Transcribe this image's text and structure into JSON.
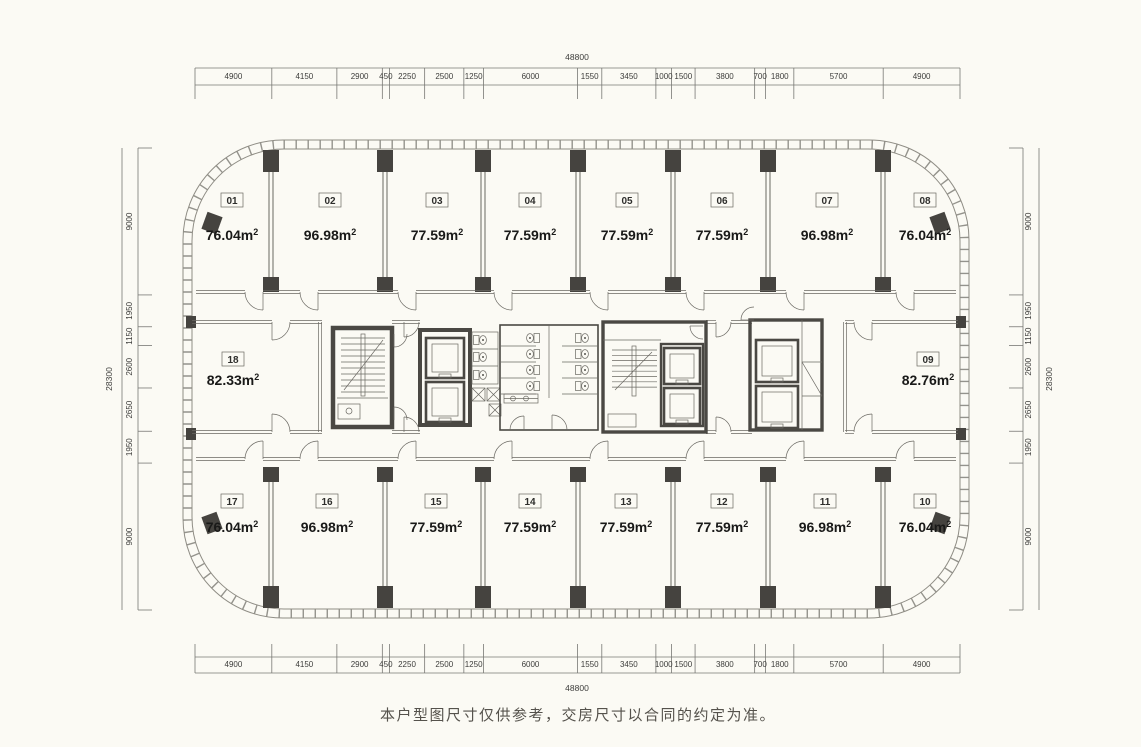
{
  "page": {
    "background": "#fbfaf4",
    "disclaimer": "本户型图尺寸仅供参考，交房尺寸以合同的约定为准。"
  },
  "dimensions": {
    "top": {
      "total": "48800",
      "segments": [
        "4900",
        "4150",
        "2900",
        "450",
        "2250",
        "2500",
        "1250",
        "6000",
        "1550",
        "3450",
        "1000",
        "1500",
        "3800",
        "700",
        "1800",
        "5700",
        "4900"
      ]
    },
    "bottom": {
      "total": "48800",
      "segments": [
        "4900",
        "4150",
        "2900",
        "450",
        "2250",
        "2500",
        "1250",
        "6000",
        "1550",
        "3450",
        "1000",
        "1500",
        "3800",
        "700",
        "1800",
        "5700",
        "4900"
      ]
    },
    "left": {
      "total": "28300",
      "segments": [
        "9000",
        "1950",
        "1150",
        "2600",
        "2650",
        "1950",
        "9000"
      ]
    },
    "right": {
      "total": "28300",
      "segments": [
        "9000",
        "1950",
        "1150",
        "2600",
        "2650",
        "1950",
        "9000"
      ]
    }
  },
  "units": {
    "top_row": [
      {
        "no": "01",
        "area": "76.04m²"
      },
      {
        "no": "02",
        "area": "96.98m²"
      },
      {
        "no": "03",
        "area": "77.59m²"
      },
      {
        "no": "04",
        "area": "77.59m²"
      },
      {
        "no": "05",
        "area": "77.59m²"
      },
      {
        "no": "06",
        "area": "77.59m²"
      },
      {
        "no": "07",
        "area": "96.98m²"
      },
      {
        "no": "08",
        "area": "76.04m²"
      }
    ],
    "middle": [
      {
        "no": "18",
        "area": "82.33m²"
      },
      {
        "no": "09",
        "area": "82.76m²"
      }
    ],
    "bottom_row": [
      {
        "no": "17",
        "area": "76.04m²"
      },
      {
        "no": "16",
        "area": "96.98m²"
      },
      {
        "no": "15",
        "area": "77.59m²"
      },
      {
        "no": "14",
        "area": "77.59m²"
      },
      {
        "no": "13",
        "area": "77.59m²"
      },
      {
        "no": "12",
        "area": "77.59m²"
      },
      {
        "no": "11",
        "area": "96.98m²"
      },
      {
        "no": "10",
        "area": "76.04m²"
      }
    ]
  }
}
